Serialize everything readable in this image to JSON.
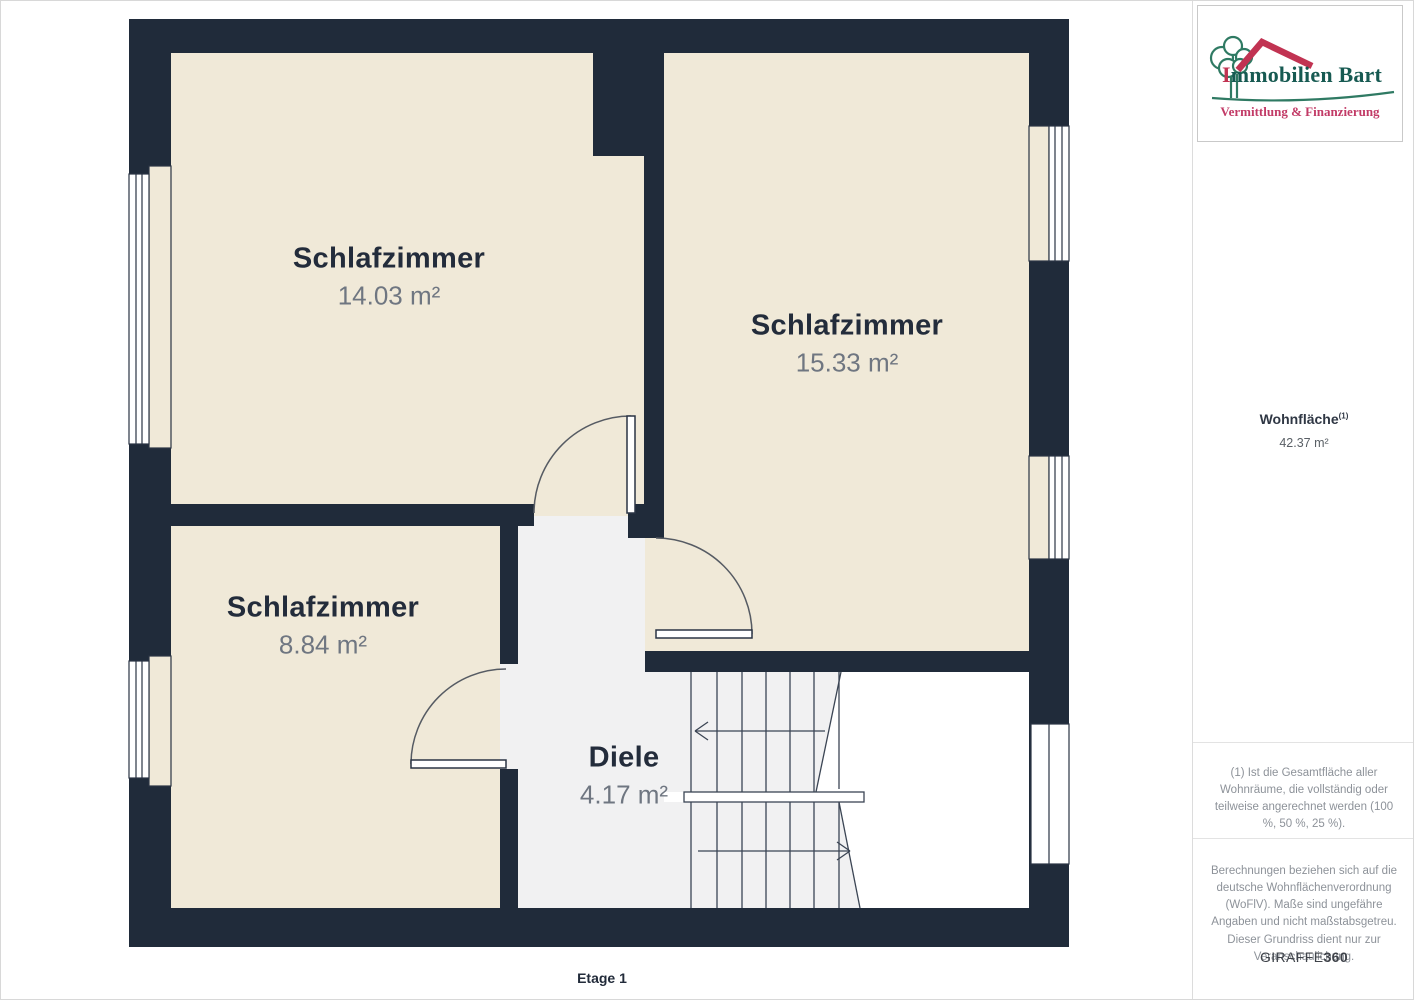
{
  "floorplan": {
    "floor_label": "Etage 1",
    "rooms": [
      {
        "name": "Schlafzimmer",
        "area": "14.03 m²"
      },
      {
        "name": "Schlafzimmer",
        "area": "15.33 m²"
      },
      {
        "name": "Schlafzimmer",
        "area": "8.84 m²"
      },
      {
        "name": "Diele",
        "area": "4.17 m²"
      }
    ]
  },
  "sidebar": {
    "logo": {
      "company": "Immobilien Bart",
      "tagline": "Vermittlung & Finanzierung"
    },
    "summary": {
      "label": "Wohnfläche",
      "footnote_marker": "(1)",
      "value": "42.37 m²"
    },
    "footnote": "(1) Ist die Gesamtfläche aller Wohnräume, die vollständig oder teilweise angerechnet werden (100 %, 50 %, 25 %).",
    "disclaimer": "Berechnungen beziehen sich auf die deutsche Wohnflächenverordnung (WoFlV). Maße sind ungefähre Angaben und nicht maßstabsgetreu. Dieser Grundriss dient nur zur Veranschaulichung.",
    "brand": {
      "name": "GIRAFFE",
      "suffix": "360"
    }
  },
  "colors": {
    "wall": "#202b3a",
    "room_fill": "#f0e9d8",
    "hall_fill": "#f1f1f2",
    "logo_green": "#2f7a63",
    "logo_red": "#c13352",
    "tagline_pink": "#c23a66"
  }
}
